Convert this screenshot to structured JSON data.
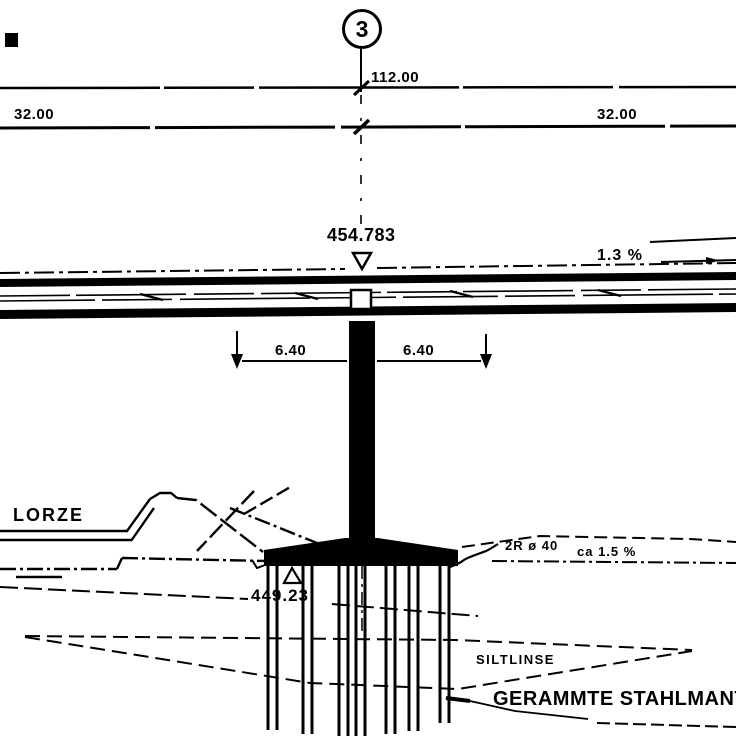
{
  "drawing": {
    "type": "bridge-elevation-section",
    "ink_color": "#000000",
    "paper_color": "#ffffff",
    "axis_number": "3",
    "dims": {
      "total": "112.00",
      "span_left": "32.00",
      "span_right": "32.00",
      "pier_left": "6.40",
      "pier_right": "6.40"
    },
    "elevations": {
      "deck": "454.783",
      "foundation": "449.23"
    },
    "annotations": {
      "deck_slope": "1.3 %",
      "pipe_note": "2R ø 40",
      "pipe_slope": "ca 1.5 %"
    },
    "labels": {
      "river": "LORZE",
      "silt_lens": "SILTLINSE",
      "piles": "GERAMMTE STAHLMANT"
    }
  }
}
